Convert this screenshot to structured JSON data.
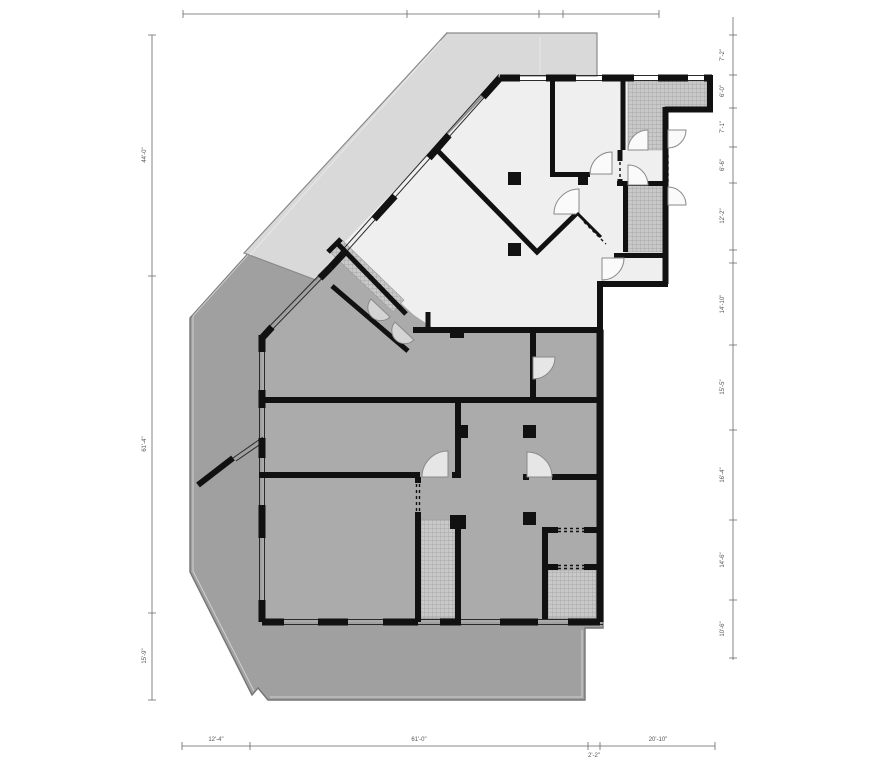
{
  "drawing": {
    "type": "architectural-floor-plan",
    "view": "plan"
  },
  "colors": {
    "wall": "#111111",
    "site_paving": "#a0a0a0",
    "terrace_paving": "#d9d9d9",
    "upper_floor": "#efefef",
    "lower_floor": "#ababab",
    "stair_hatch": "#c9c9c9",
    "dimension": "#555555"
  },
  "dimensions": {
    "right_labels": [
      "7'-2\"",
      "6'-0\"",
      "7'-1\"",
      "6'-6\"",
      "12'-2\"",
      "14'-10\"",
      "15'-5\"",
      "16'-4\"",
      "14'-6\"",
      "10'-6\""
    ],
    "left_labels": [
      "44'-0\"",
      "61'-4\"",
      "15'-9\""
    ],
    "bottom_labels": [
      "12'-4\"",
      "61'-0\"",
      "2'-2\"",
      "20'-10\""
    ]
  }
}
